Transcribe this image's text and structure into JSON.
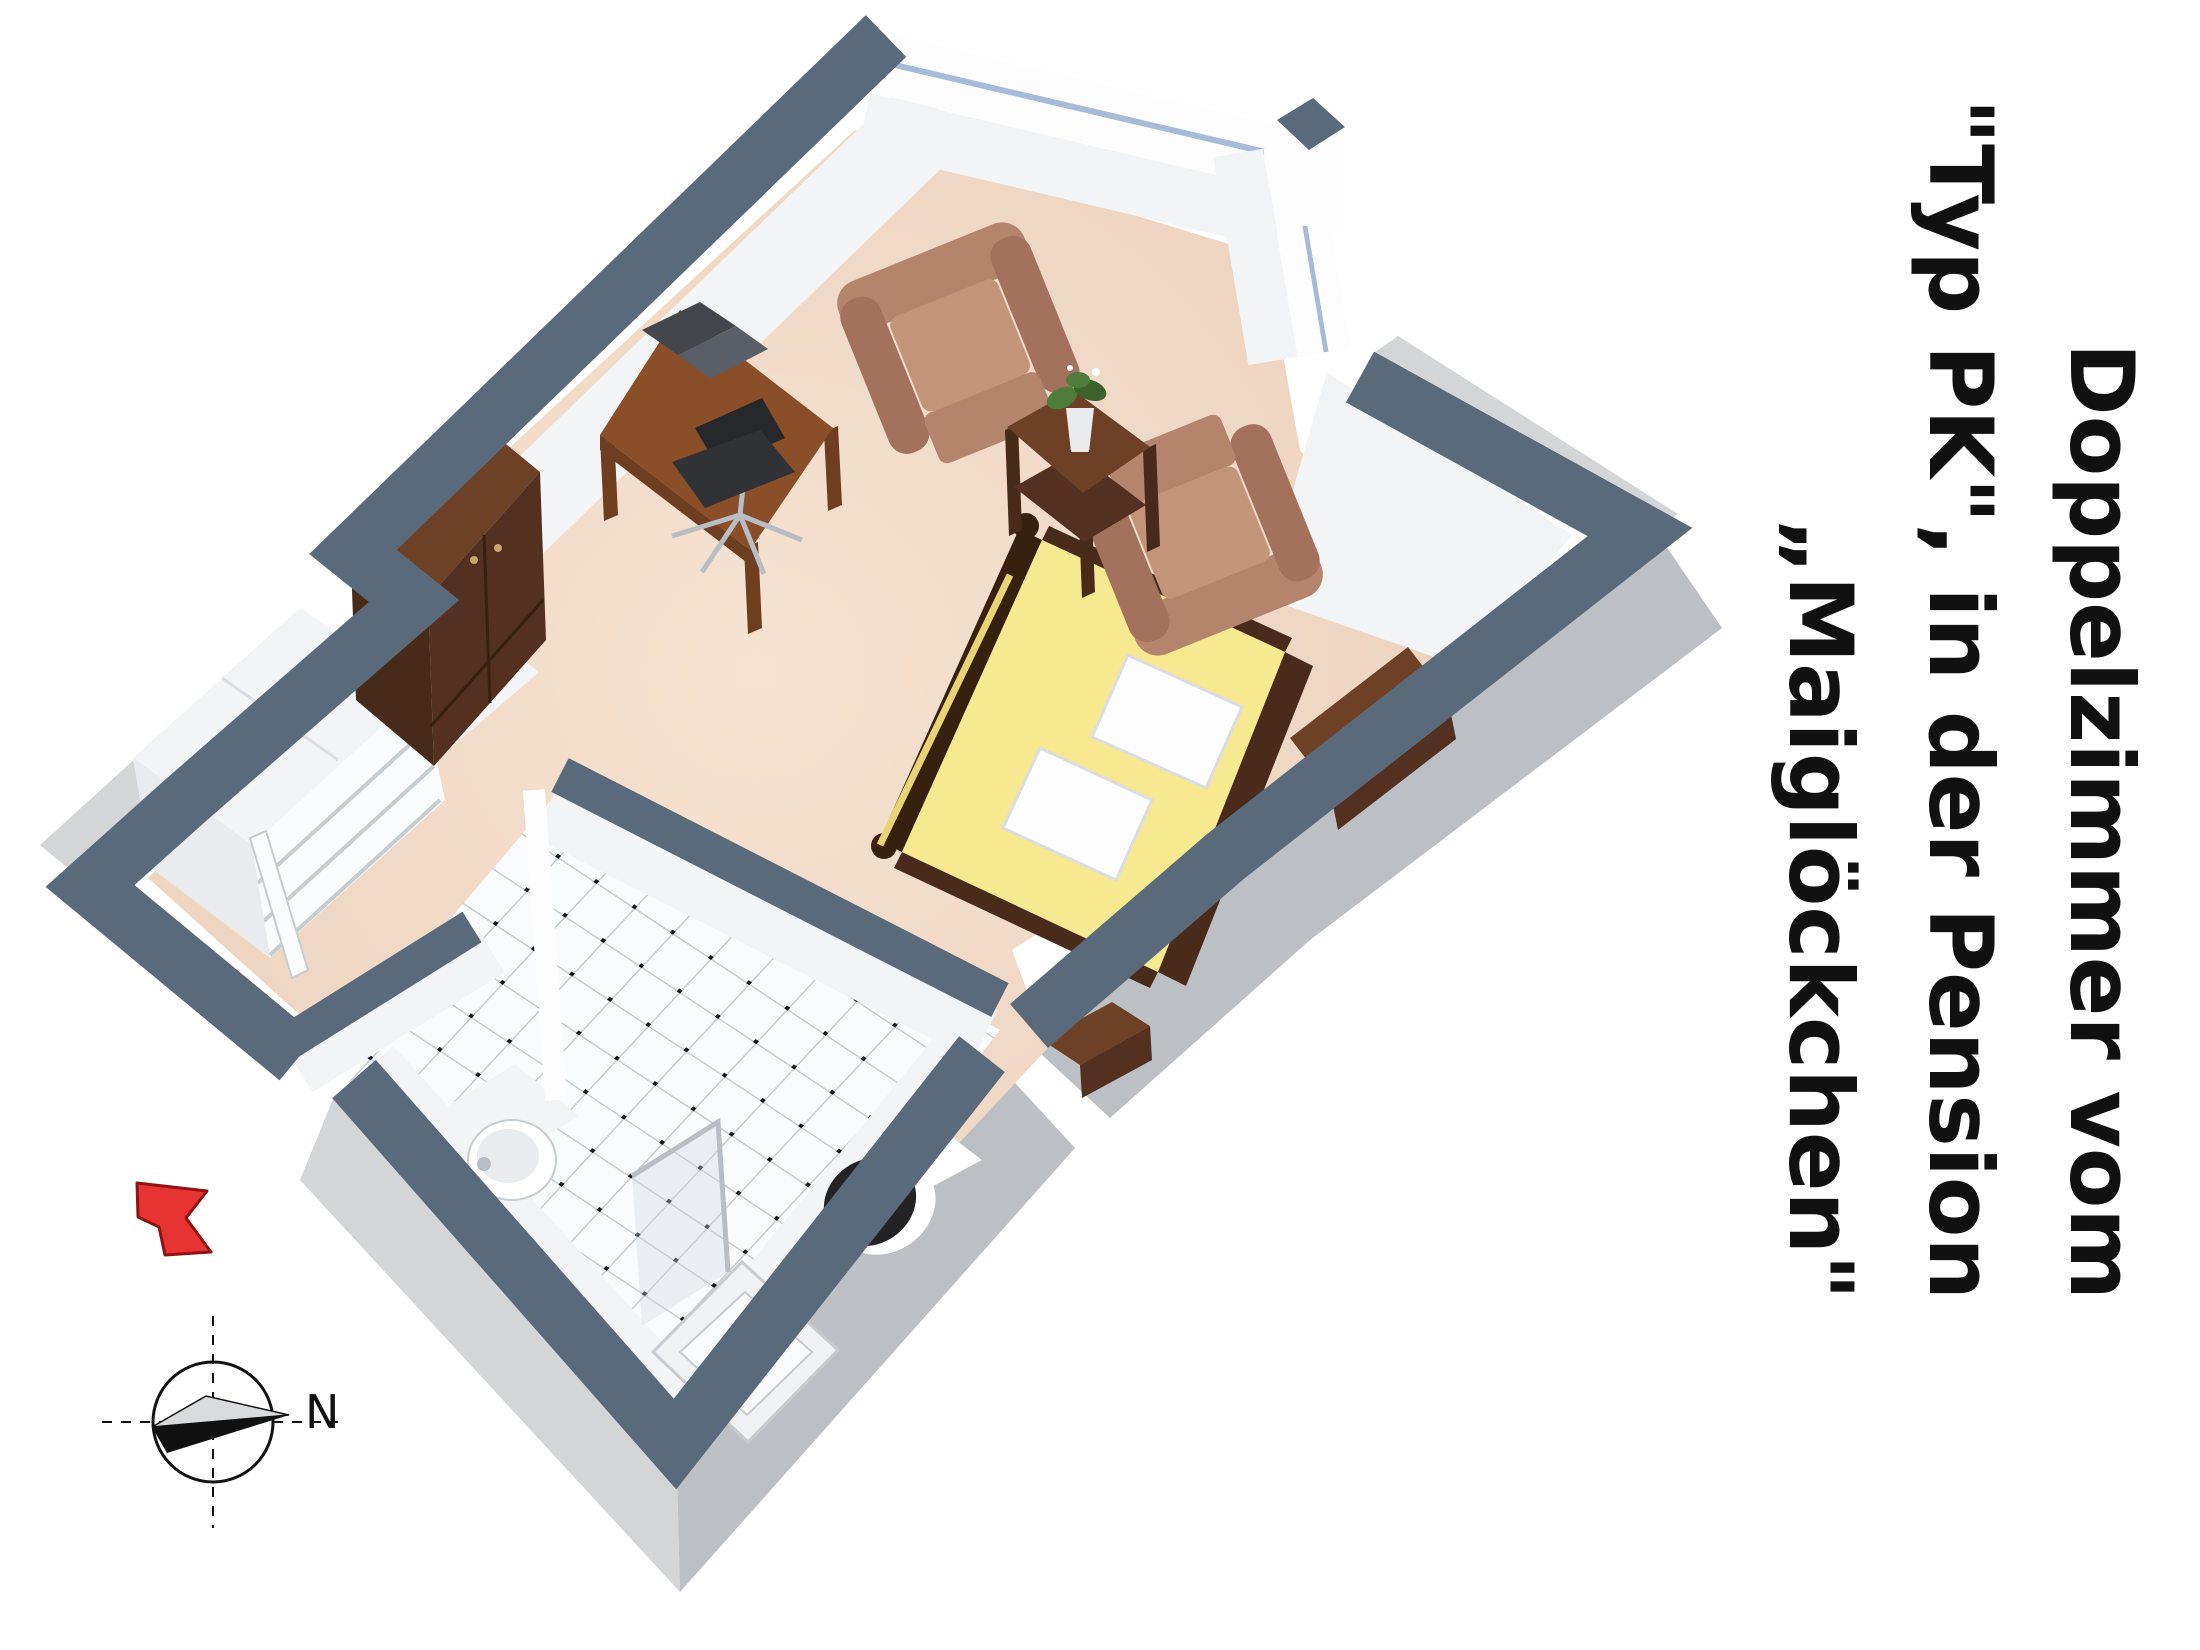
{
  "title": {
    "lines": [
      "Doppelzimmer vom",
      "\"Typ PK\", in der Pension",
      "„Maiglöckchen\""
    ]
  },
  "compass": {
    "label": "N"
  },
  "icons": {
    "compass": "compass-rose-icon",
    "entry_arrow": "red-entry-arrow-icon"
  },
  "objects": [
    "double-bed",
    "pillow",
    "pillow",
    "armchair",
    "armchair",
    "coffee-table",
    "plant",
    "desk",
    "laptop",
    "office-chair",
    "wardrobe",
    "shelf-unit",
    "sideboard",
    "nightstand",
    "entry-door",
    "washbasin",
    "toilet",
    "shower"
  ],
  "colors": {
    "wall_top": "#5a6a7a",
    "wall_ext_light": "#d3d5d7",
    "wall_ext_mid": "#bcbfc3",
    "wall_face": "#f3f4f6",
    "wall_face_shaded": "#e9ebee",
    "window_white": "#fdfdfe",
    "glass_blue": "#a9bad8",
    "floor_light": "#f6e3d1",
    "floor_mid": "#e9cfba",
    "tile_white": "#fafbfc",
    "tile_line": "#c7ccd1",
    "tile_dot": "#15161a",
    "mattress": "#f6e98f",
    "mattress_fold": "#e7d477",
    "pillow": "#fdfdfe",
    "pillow_edge": "#dcdde2",
    "bed_frame": "#4a2a1b",
    "bed_frame_dark": "#38200f",
    "wood_top": "#6e4026",
    "wood_front": "#53301f",
    "wood_side": "#472a18",
    "wood_knob": "#c9a66b",
    "desk_top": "#8a4e28",
    "desk_leg": "#6f3d1f",
    "laptop_screen": "#43464b",
    "laptop_base": "#5a5e66",
    "chair_black": "#26282b",
    "chair_black2": "#303236",
    "chrome": "#b9bec4",
    "armchair_mid": "#b5846d",
    "armchair_dark": "#a3715c",
    "armchair_light": "#c39478",
    "plant_green": "#4e7c3a",
    "plant_green_dark": "#3c6129",
    "vase": "#e8eaec",
    "door_white": "#fbfcfd",
    "shower_tray": "#f0f1f3",
    "glass_pane": "#ccd6e2",
    "toilet_black": "#232326",
    "white": "#ffffff",
    "ink": "#111111",
    "arrow_red": "#e73331",
    "arrow_red_dark": "#8f1310",
    "compass_gray": "#d9dadc",
    "shadow": "#00000012"
  }
}
